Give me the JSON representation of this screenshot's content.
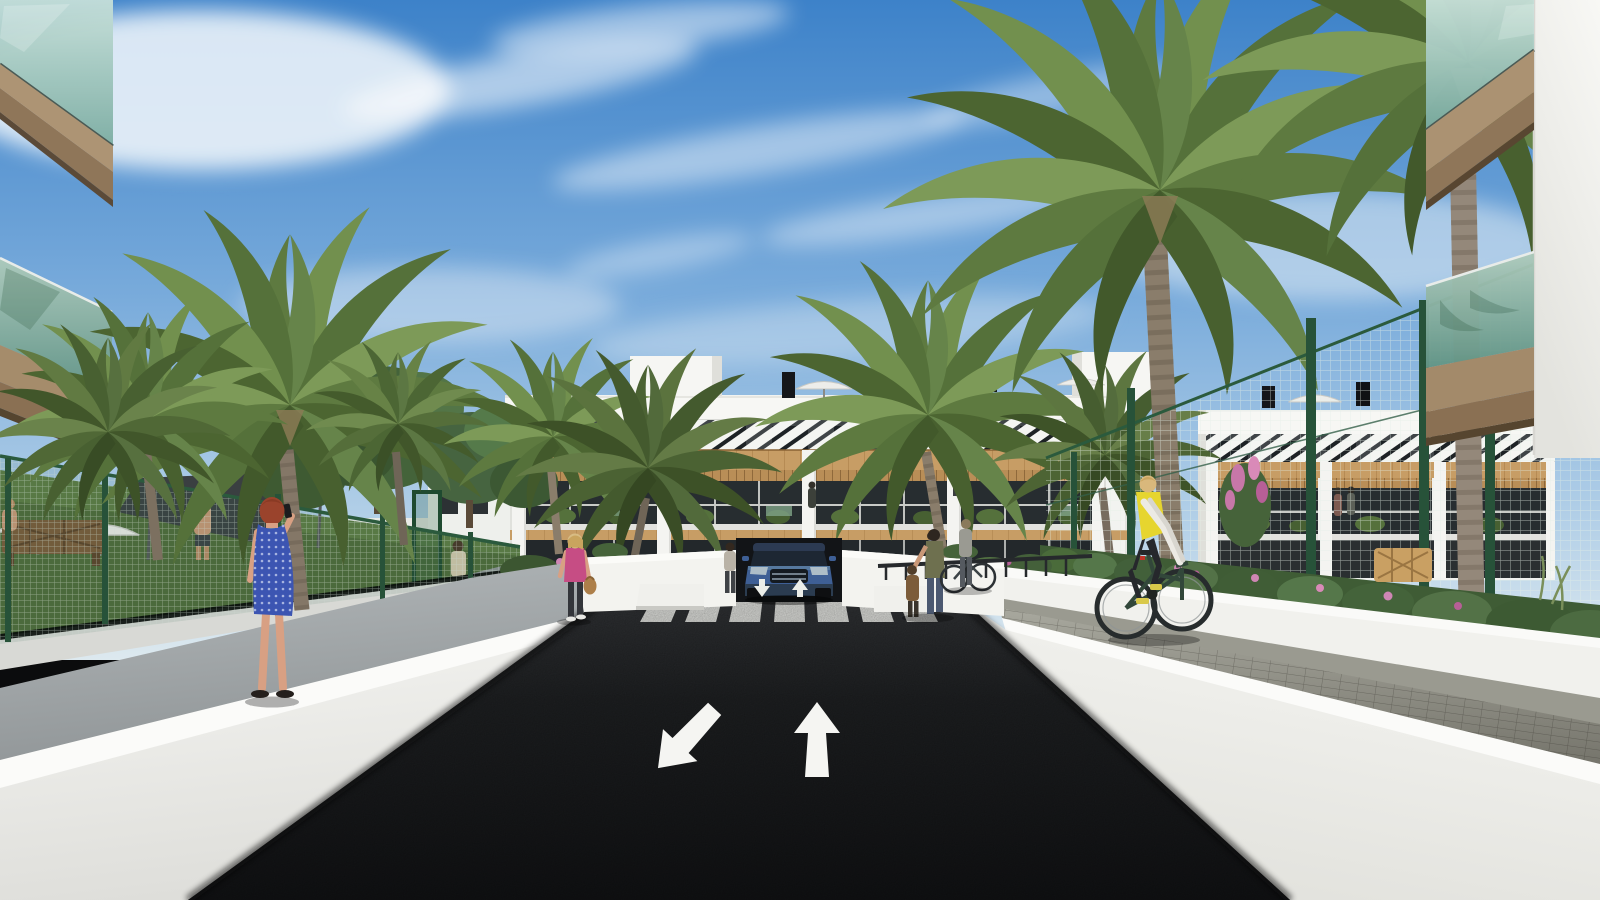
{
  "meta": {
    "type": "architectural-exterior-render",
    "width": 1600,
    "height": 900,
    "text_visible": false
  },
  "labels": {
    "scene": "street view render of a modern white apartment complex with palm trees",
    "sky": "blue sky with wispy cirrus clouds",
    "building_main": "three-storey white apartment building with wood accents and slatted pergola roofline",
    "building_right": "right wing of the apartment building behind green mesh fence",
    "building_left_annex": "small white annex building behind garden trees",
    "balcony_top_left": "foreground glass balconies, top left corner",
    "balcony_top_right": "foreground glass balconies, top right corner",
    "road": "dark asphalt access road",
    "crosswalk": "white zebra crosswalk",
    "arrow_up": "white lane arrow pointing away from viewer",
    "arrow_down_left": "white lane arrow pointing toward viewer",
    "ramp_arrows": "small in/out arrows at garage ramp",
    "garage": "underground garage entrance",
    "car": "blue SUV at the garage ramp",
    "fence_left": "green mesh fence around pool garden",
    "fence_right": "green mesh fence along right garden",
    "pool_area": "pool terrace with white parasols and dark shade sail",
    "palms": "tall palm trees",
    "trees": "leafy garden trees",
    "woman_blue": "red-haired woman in blue polka-dot dress talking on phone",
    "woman_pink": "blonde woman in pink top carrying a handbag",
    "man_path": "man walking toward the garden gate",
    "cyclist": "cyclist in yellow vest on paver path",
    "woman_child": "woman with child near the bike racks",
    "bike_woman": "woman with a bicycle",
    "terrace_woman": "resident standing on ground-floor terrace",
    "balcony_people": "small figures on balconies",
    "pool_people": "people at the pool terrace",
    "bike_racks": "dark bike racks against white wall",
    "flower_bed": "flower bed with pink blossoms",
    "wicker_bench": "wicker lattice bench",
    "walls": "white boundary walls flanking the road",
    "walkway_left": "grey pedestrian walkway on the left",
    "paver_path_right": "paver pedestrian path on the right"
  },
  "palette": {
    "sky_top": "#3d82c9",
    "sky_mid": "#79abdb",
    "sky_horizon": "#dde9ef",
    "cloud_white": "#f4f8fb",
    "asphalt_dark": "#1c1e20",
    "marking_white": "#f2f3ef",
    "wall_white": "#f2f2ee",
    "wood_accent": "#c79d65",
    "pergola_shadow": "#3f4447",
    "window_dark": "#262c2f",
    "glass_teal": "#8fb7ac",
    "soffit_tan": "#a18a6a",
    "fence_green": "#2b5a3d",
    "palm_green": "#6d8a4c",
    "lawn_green": "#5d7c44",
    "dress_blue": "#3c55b2",
    "top_pink": "#c64d84",
    "vest_yellow": "#e6d52f",
    "car_blue": "#3e5f95",
    "hair_red": "#9a432c",
    "flower_pink": "#c777a8",
    "paver_grey": "#6f6e64"
  },
  "counts": {
    "crosswalk_stripes": 7,
    "road_arrows": 2,
    "ramp_arrows": 2,
    "palm_trees": 10,
    "roof_parasols": 4,
    "pool_parasols": 3,
    "people_visible": 13,
    "building_floors": 3
  }
}
